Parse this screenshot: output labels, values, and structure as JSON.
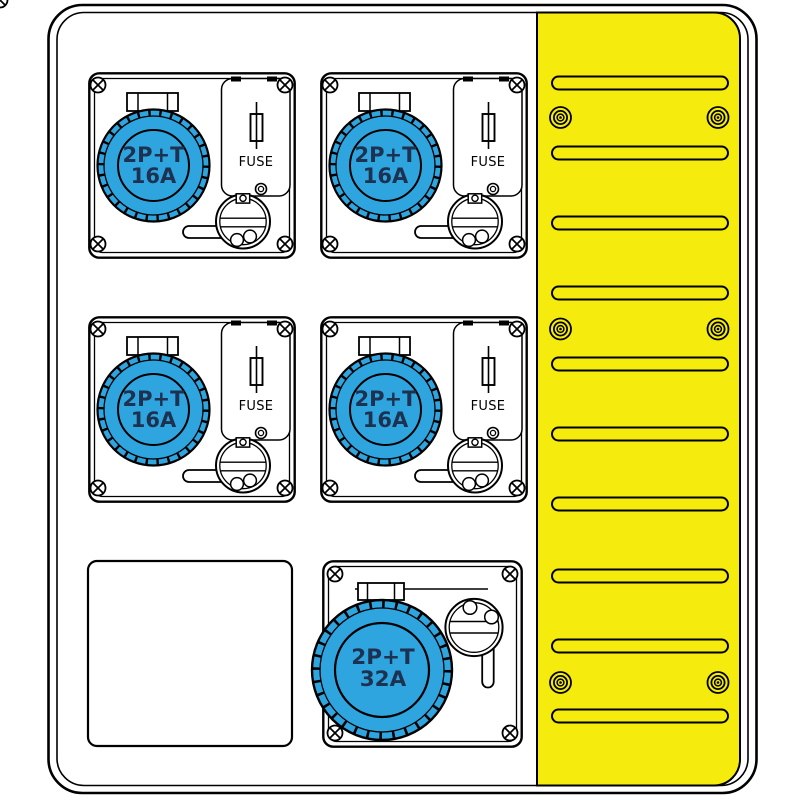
{
  "canvas": {
    "background": "#ffffff",
    "line_color": "#000000"
  },
  "sockets": {
    "type_16a": {
      "line1": "2P+T",
      "line2": "16A",
      "fuse": "FUSE",
      "count": 4,
      "color": "#2EA5DF",
      "label_color": "#1D3150"
    },
    "type_32a": {
      "line1": "2P+T",
      "line2": "32A",
      "count": 1,
      "color": "#2EA5DF",
      "label_color": "#1D3150"
    }
  },
  "vent_panel": {
    "color": "#F5EB0C",
    "slot_count": 10,
    "screw_count": 6
  },
  "blank_plate": {
    "count": 1
  }
}
